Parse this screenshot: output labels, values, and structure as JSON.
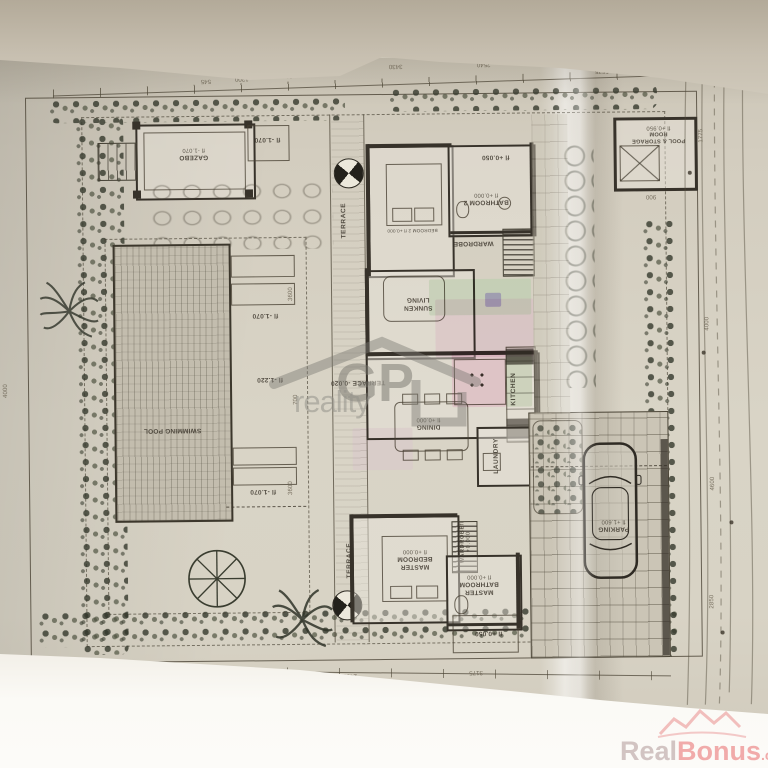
{
  "labels": {
    "gazebo": "GAZEBO",
    "gazebo_level": "fl -1.070",
    "gazebo_box_level": "fl -1.070",
    "lounge_top_level": "fl -1.070",
    "lounge_bottom_level": "fl -1.070",
    "pool_deck_level": "fl -1.220",
    "swimming_pool": "SWIMMING POOL",
    "terrace_top": "TERRACE",
    "terrace_mid": "TERRACE -0.020",
    "terrace_bottom": "TERRACE",
    "bedroom2": "BEDROOM 2 fl +0.000",
    "bathroom2": "BATHROOM 2",
    "bathroom2_level": "fl +0.000",
    "hall_level": "fl +0.050",
    "wardrobe_top": "WARDROBE",
    "sunken_living": "SUNKEN LIVING",
    "kitchen": "KITCHEN",
    "dining": "DINING",
    "dining_level": "fl +0.000",
    "laundry": "LAUNDRY",
    "wardrobe_bottom": "WARDROBE",
    "wardrobe_bottom_level": "fl +0.000",
    "master_bedroom": "MASTER BEDROOM",
    "master_bedroom_level": "fl +0.000",
    "master_bathroom": "MASTER BATHROOM",
    "master_bathroom_level": "fl +0.000",
    "entry_level": "fl +0.050",
    "parking": "PARKING",
    "parking_level": "fl +1.600",
    "pool_storage": "POOL & STORAGE ROOM",
    "pool_storage_level": "fl +0.950"
  },
  "dims": {
    "top": [
      "545",
      "1200",
      "2025",
      "1200",
      "3430",
      "2540",
      "5575"
    ],
    "bottom": [
      "4990",
      "2600",
      "1325",
      "2400",
      "3175"
    ],
    "right": [
      "1775",
      "4000",
      "4600",
      "2850"
    ],
    "left": [
      "4000"
    ],
    "pool_side": [
      "3600",
      "700",
      "3600"
    ],
    "storage_side": [
      "900"
    ]
  },
  "watermarks": {
    "gp_logo": "GP",
    "gp_text": "reality",
    "rb_real": "Real",
    "rb_bonus": "Bonus",
    "rb_cz": ".cz"
  }
}
